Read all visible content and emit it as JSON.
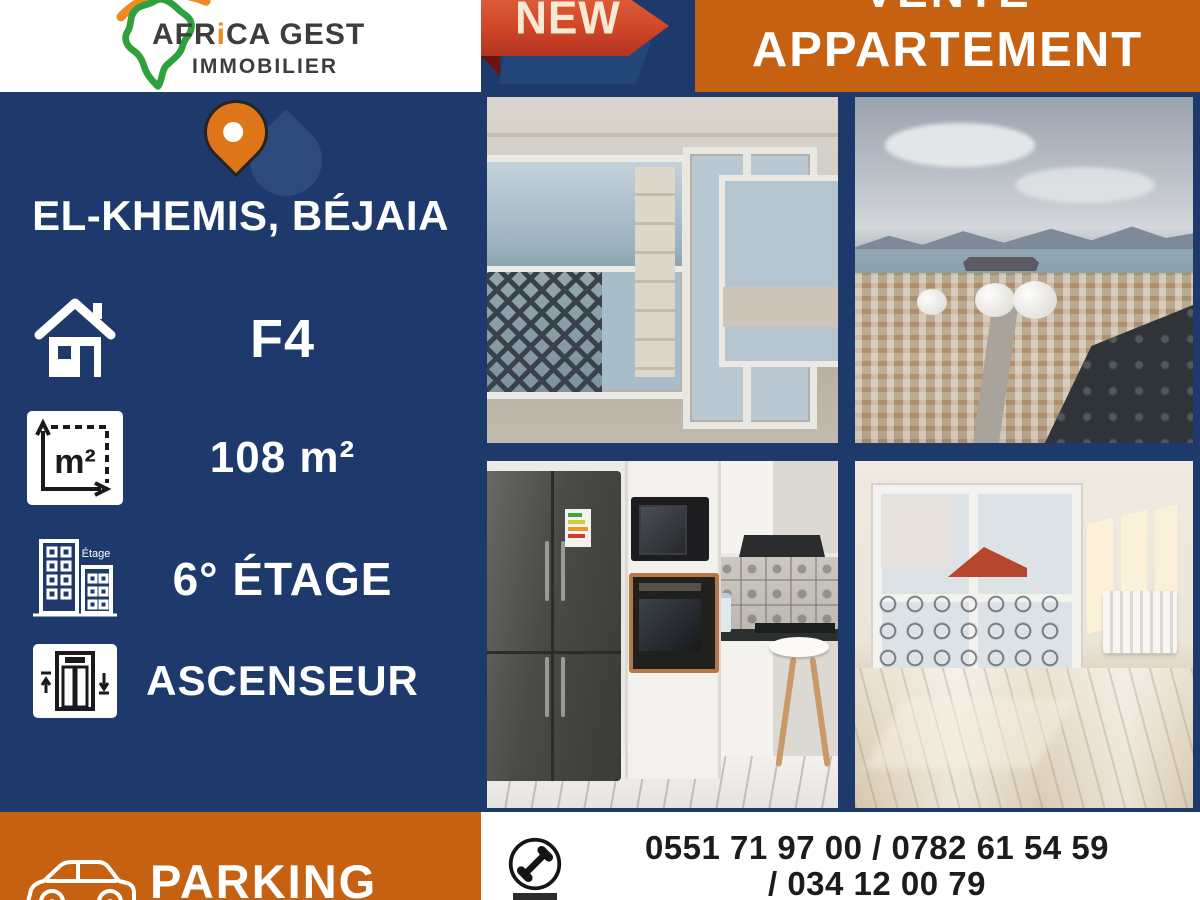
{
  "colors": {
    "navy": "#1e3a6c",
    "orange": "#c76112",
    "ribbon_red": "#cf4527",
    "ribbon_red_dark": "#6e100c",
    "ribbon_cream": "#f7ead5",
    "pin_orange": "#de7519",
    "logo_green": "#2fa13c",
    "logo_orange": "#ee8a1e",
    "white": "#ffffff",
    "text_dark": "#1c1c1c"
  },
  "header": {
    "logo": {
      "part1": "AFR",
      "accent": "i",
      "part2": "CA GEST",
      "line2": "IMMOBILIER"
    },
    "badge": "NEW",
    "banner": {
      "line1": "VENTE",
      "line2": "APPARTEMENT"
    }
  },
  "sidebar": {
    "location": "EL-KHEMIS, BÉJAIA",
    "features": [
      {
        "icon": "house-icon",
        "label": "F4"
      },
      {
        "icon": "area-icon",
        "label": "108 m²",
        "glyph": "m²"
      },
      {
        "icon": "building-icon",
        "label": "6° ÉTAGE",
        "icon_text": "Étage"
      },
      {
        "icon": "elevator-icon",
        "label": "ASCENSEUR"
      }
    ],
    "parking": {
      "icon": "car-icon",
      "label": "PARKING"
    }
  },
  "photos": [
    {
      "alt": "Unfinished living room with panoramic windows over the bay"
    },
    {
      "alt": "Balcony view over Béjaia city, port and mountains"
    },
    {
      "alt": "Fitted kitchen with dark fridge and built-in oven"
    },
    {
      "alt": "Sunlit empty room with marble floor and radiator"
    }
  ],
  "contact": {
    "icon": "phone-icon",
    "line1": "0551 71 97 00 / 0782 61 54 59",
    "line2": "/ 034 12 00 79"
  }
}
